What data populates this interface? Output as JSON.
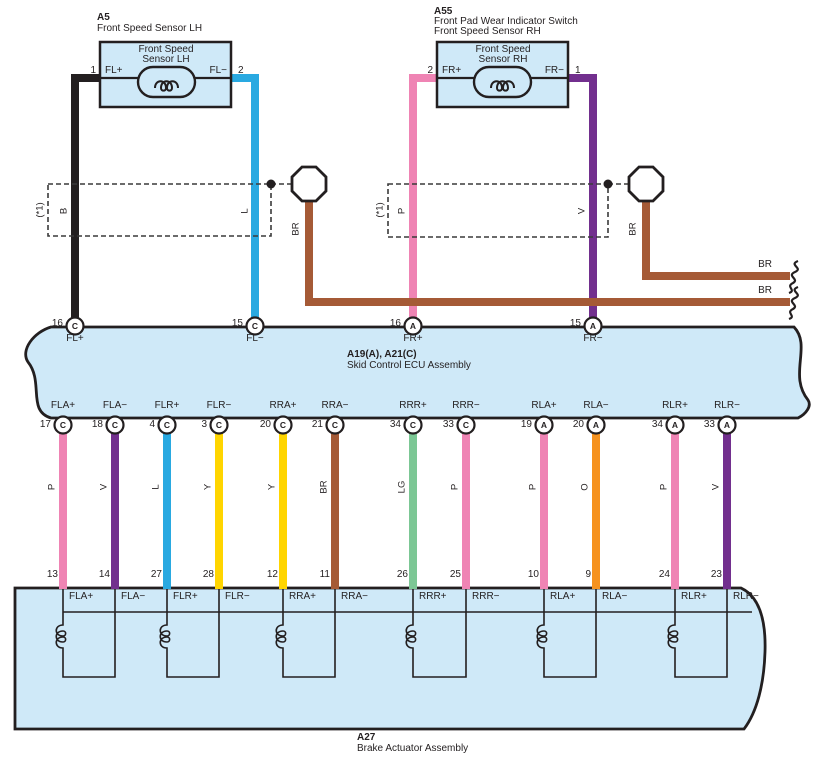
{
  "palette": {
    "B": "#231f20",
    "L": "#29a9e1",
    "P": "#ef84b4",
    "V": "#722f8e",
    "BR": "#a55a36",
    "Y": "#ffd500",
    "LG": "#7cc795",
    "O": "#f6921e",
    "band_fill": "#cfe9f8",
    "line": "#231f20"
  },
  "sensor_lh": {
    "code": "A5",
    "title": "Front Speed Sensor LH",
    "inner_line1": "Front Speed",
    "inner_line2": "Sensor LH",
    "pin_left_num": "1",
    "pin_left_label": "FL+",
    "pin_right_label": "FL−",
    "pin_right_num": "2"
  },
  "sensor_rh": {
    "code": "A55",
    "title_line1": "Front Pad Wear Indicator Switch",
    "title_line2": "Front Speed Sensor RH",
    "inner_line1": "Front Speed",
    "inner_line2": "Sensor RH",
    "pin_left_num": "2",
    "pin_left_label": "FR+",
    "pin_right_label": "FR−",
    "pin_right_num": "1"
  },
  "shield_left": {
    "note": "(*1)",
    "wire1": "B",
    "wire2": "L",
    "drain": "BR"
  },
  "shield_right": {
    "note": "(*1)",
    "wire1": "P",
    "wire2": "V",
    "drain": "BR"
  },
  "br_runs": {
    "upper_label": "BR",
    "lower_label": "BR"
  },
  "ecu": {
    "code": "A19(A), A21(C)",
    "name": "Skid Control ECU Assembly",
    "top_pins": [
      {
        "num": "16",
        "conn": "C",
        "label": "FL+"
      },
      {
        "num": "15",
        "conn": "C",
        "label": "FL−"
      },
      {
        "num": "16",
        "conn": "A",
        "label": "FR+"
      },
      {
        "num": "15",
        "conn": "A",
        "label": "FR−"
      }
    ],
    "bottom_pins": [
      {
        "num": "17",
        "conn": "C",
        "label": "FLA+",
        "wire": "P"
      },
      {
        "num": "18",
        "conn": "C",
        "label": "FLA−",
        "wire": "V"
      },
      {
        "num": "4",
        "conn": "C",
        "label": "FLR+",
        "wire": "L"
      },
      {
        "num": "3",
        "conn": "C",
        "label": "FLR−",
        "wire": "Y"
      },
      {
        "num": "20",
        "conn": "C",
        "label": "RRA+",
        "wire": "Y"
      },
      {
        "num": "21",
        "conn": "C",
        "label": "RRA−",
        "wire": "BR"
      },
      {
        "num": "34",
        "conn": "C",
        "label": "RRR+",
        "wire": "LG"
      },
      {
        "num": "33",
        "conn": "C",
        "label": "RRR−",
        "wire": "P"
      },
      {
        "num": "19",
        "conn": "A",
        "label": "RLA+",
        "wire": "P"
      },
      {
        "num": "20",
        "conn": "A",
        "label": "RLA−",
        "wire": "O"
      },
      {
        "num": "34",
        "conn": "A",
        "label": "RLR+",
        "wire": "P"
      },
      {
        "num": "33",
        "conn": "A",
        "label": "RLR−",
        "wire": "V"
      }
    ]
  },
  "actuator": {
    "code": "A27",
    "name": "Brake Actuator Assembly",
    "pins": [
      {
        "num": "13",
        "label": "FLA+"
      },
      {
        "num": "14",
        "label": "FLA−"
      },
      {
        "num": "27",
        "label": "FLR+"
      },
      {
        "num": "28",
        "label": "FLR−"
      },
      {
        "num": "12",
        "label": "RRA+"
      },
      {
        "num": "11",
        "label": "RRA−"
      },
      {
        "num": "26",
        "label": "RRR+"
      },
      {
        "num": "25",
        "label": "RRR−"
      },
      {
        "num": "10",
        "label": "RLA+"
      },
      {
        "num": "9",
        "label": "RLA−"
      },
      {
        "num": "24",
        "label": "RLR+"
      },
      {
        "num": "23",
        "label": "RLR−"
      }
    ]
  }
}
